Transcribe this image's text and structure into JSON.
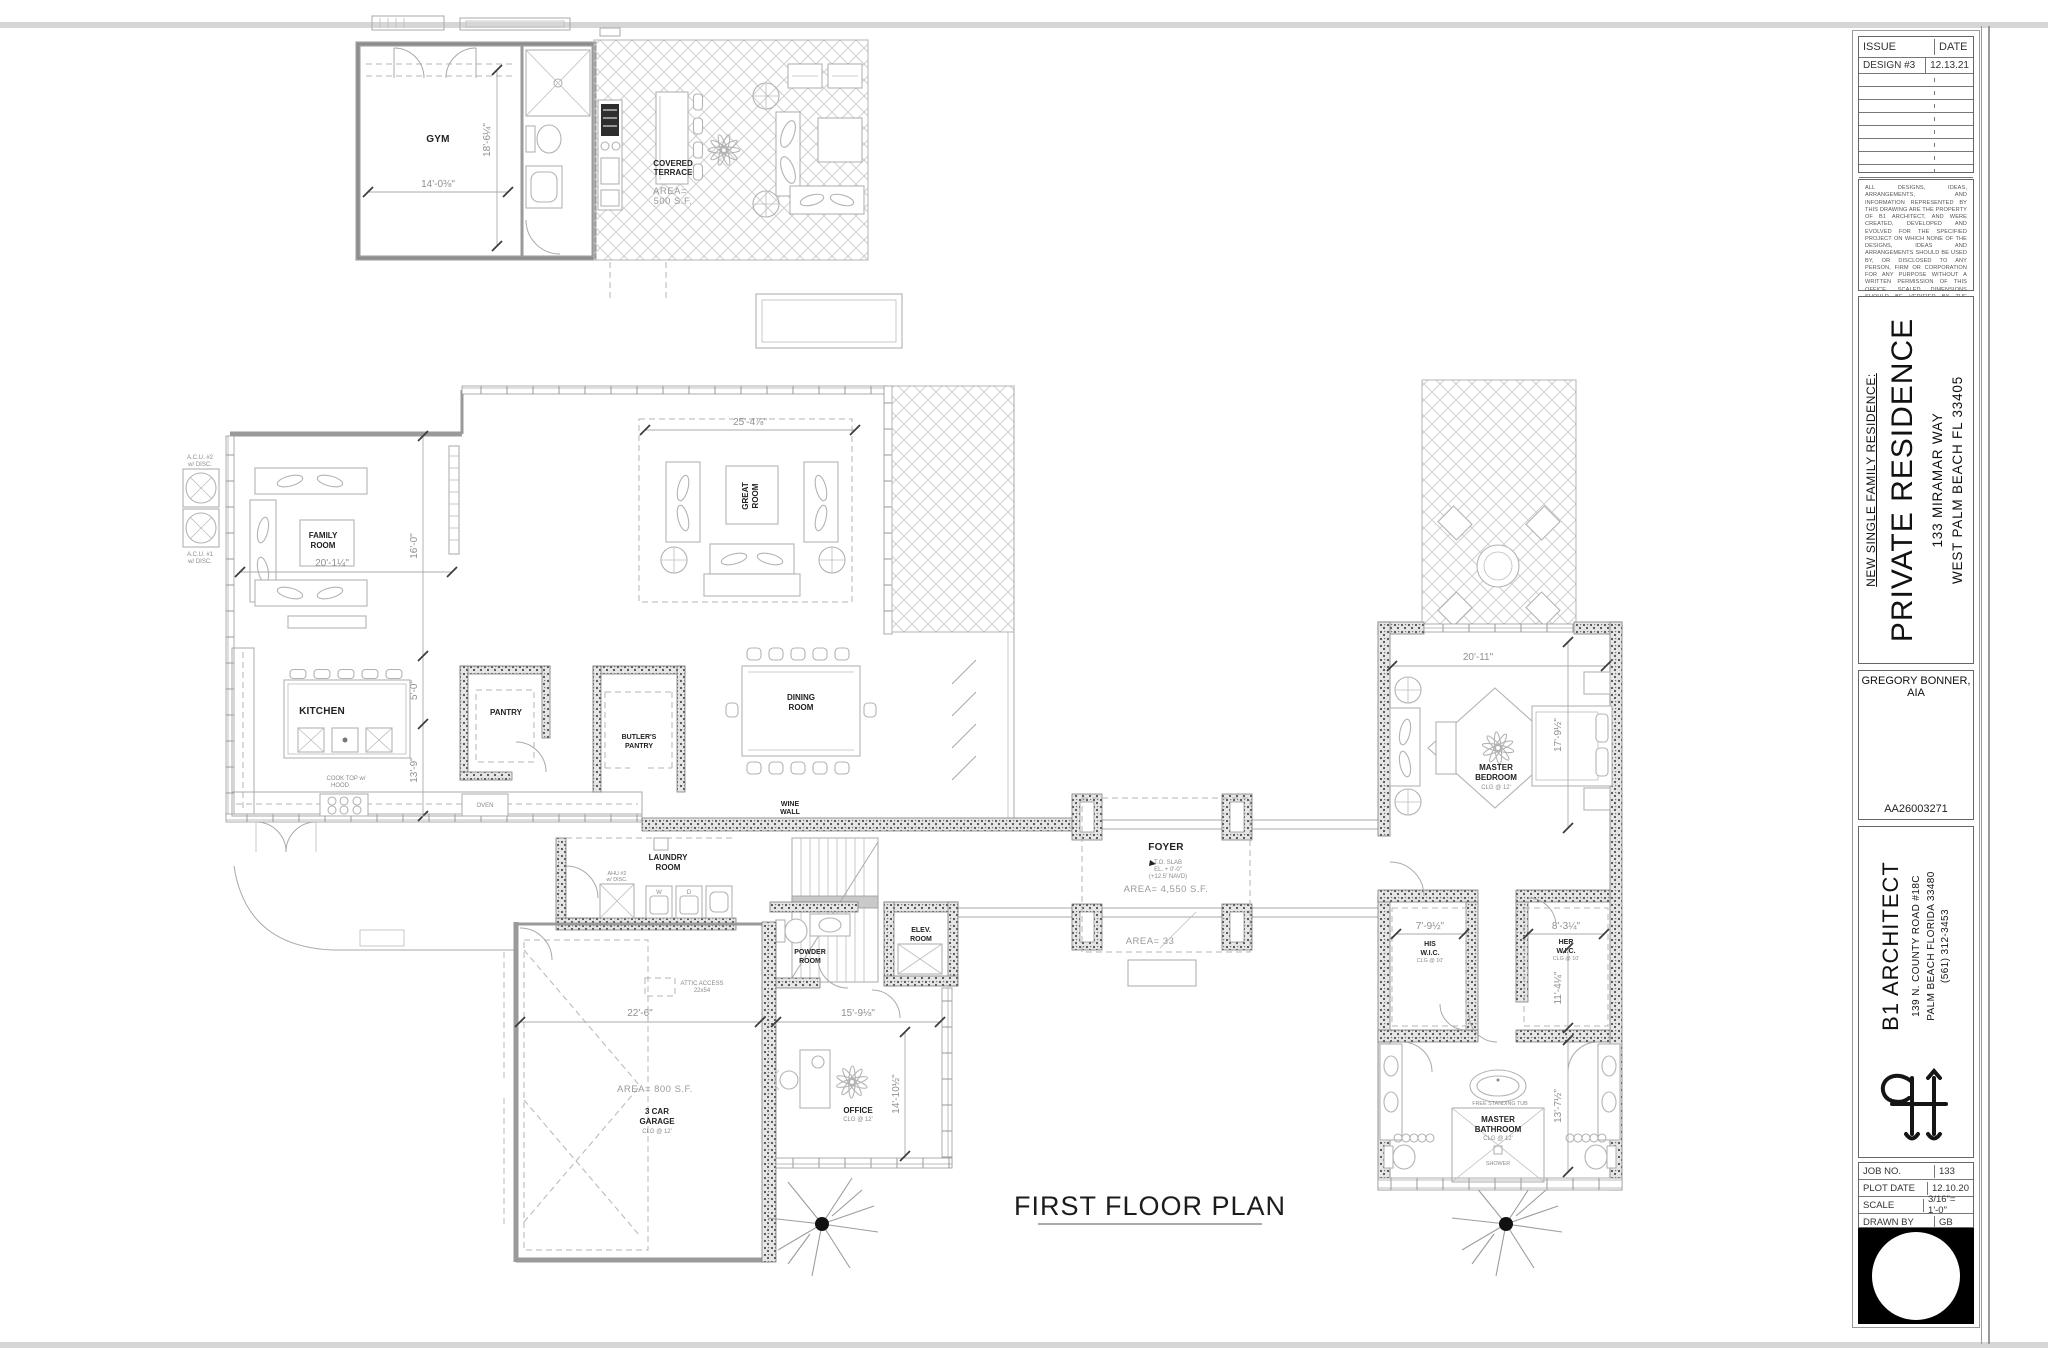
{
  "plan": {
    "title": "FIRST FLOOR PLAN",
    "rooms": {
      "gym": "GYM",
      "covered_terrace": [
        "COVERED",
        "TERRACE"
      ],
      "covered_terrace_area": [
        "AREA=",
        "500 S.F."
      ],
      "family_room": [
        "FAMILY",
        "ROOM"
      ],
      "great_room": [
        "GREAT",
        "ROOM"
      ],
      "kitchen": "KITCHEN",
      "pantry": "PANTRY",
      "butlers_pantry": [
        "BUTLER'S",
        "PANTRY"
      ],
      "dining_room": [
        "DINING",
        "ROOM"
      ],
      "wine_wall": [
        "WINE",
        "WALL"
      ],
      "laundry_room": [
        "LAUNDRY",
        "ROOM"
      ],
      "powder_room": [
        "POWDER",
        "ROOM"
      ],
      "elev_room": [
        "ELEV.",
        "ROOM"
      ],
      "foyer": "FOYER",
      "garage": [
        "3 CAR",
        "GARAGE"
      ],
      "office": "OFFICE",
      "master_bedroom": [
        "MASTER",
        "BEDROOM"
      ],
      "his_wic": [
        "HIS",
        "W.I.C."
      ],
      "her_wic": [
        "HER",
        "W.I.C."
      ],
      "master_bathroom": [
        "MASTER",
        "BATHROOM"
      ],
      "shower": "SHOWER",
      "tub": "FREE STANDING TUB"
    },
    "notes": {
      "slab": [
        "T.O. SLAB",
        "EL. + 0'-0\"",
        "(+12.5' NAVD)"
      ],
      "foyer_area": "AREA=  4,550 S.F.",
      "entry_area": "AREA= 33",
      "garage_area": "AREA=  800 S.F.",
      "clg12": "CLG @ 12'",
      "clg10": "CLG @ 10'",
      "attic1": "ATTIC ACCESS",
      "attic2": "22x54",
      "cooktop1": "COOK TOP  w/",
      "cooktop2": "HOOD",
      "oven": "OVEN",
      "washer": "W",
      "dryer": "D",
      "ahu": [
        "AHU #2",
        "w/ DISC."
      ],
      "acu1": [
        "A.C.U.  #1",
        "w/ DISC."
      ],
      "acu2": [
        "A.C.U.  #2",
        "w/ DISC."
      ]
    },
    "dims": {
      "gym_w": "14'-0⅜\"",
      "gym_h": "18'-6¼\"",
      "great_w": "25'-4⅞\"",
      "family_w": "20'-1¼\"",
      "left_a": "16'-0\"",
      "left_b": "5'-0\"",
      "left_c": "13'-9\"",
      "garage_w": "22'-6\"",
      "office_w": "15'-9⅛\"",
      "office_h": "14'-10½\"",
      "master_w": "20'-11\"",
      "master_h": "17'-9½\"",
      "his_w": "7'-9½\"",
      "her_w": "8'-3¼\"",
      "her_h": "11'-4¼\"",
      "bath_h": "13'-7½\""
    }
  },
  "titleblock": {
    "issue": {
      "col_issue": "ISSUE",
      "col_date": "DATE",
      "row1_issue": "DESIGN #3",
      "row1_date": "12.13.21"
    },
    "disclaimer": "ALL DESIGNS, IDEAS, ARRANGEMENTS, AND INFORMATION REPRESENTED BY THIS DRAWING ARE THE PROPERTY OF B1 ARCHITECT, AND WERE CREATED, DEVELOPED AND EVOLVED FOR THE SPECIFIED PROJECT ON WHICH NONE OF THE DESIGNS, IDEAS AND ARRANGEMENTS SHOULD BE USED BY, OR DISCLOSED TO ANY PERSON, FIRM OR CORPORATION FOR ANY PURPOSE WITHOUT A WRITTEN PERMISSION OF THIS OFFICE. SCALED DIMENSIONS SHOULD BE VERIFIED BY THE CONTRACTOR WHO SHALL BE RESPONSIBLE FOR ALL DIMENSIONS AND CONDITIONS OF THE JOB. WRITTEN DIMENSIONS SHALL TAKE PRECEDENCE OVER SCALED DIMENSIONS. CONTRACTOR SHALL NOTIFY THIS OFFICE OF ANY VARIATIONS IN DIMENSIONS AND CONDITIONS SHOWN ON THESE DRAWINGS. SHOP DETAILS WITH ADEQUATE DIMENSIONS AND SCALE MUST BE SUBMITTED TO THIS OFFICE FOR APPROVAL BEFORE PROCEEDING WITH FABRICATION OF THE ITEMS INDICATED.",
    "project": {
      "kicker": "NEW  SINGLE FAMILY RESIDENCE:",
      "name": "PRIVATE RESIDENCE",
      "address1": "133 MIRAMAR WAY",
      "address2": "WEST PALM BEACH  FL 33405"
    },
    "architect": {
      "name": "GREGORY BONNER, AIA",
      "license": "AA26003271"
    },
    "firm": {
      "name": "B1 ARCHITECT",
      "address1": "139 N. COUNTY ROAD #18C",
      "address2": "PALM BEACH FLORIDA 33480",
      "phone": "(561) 312-3453"
    },
    "info": {
      "r1l": "JOB NO.",
      "r1v": "133",
      "r2l": "PLOT DATE",
      "r2v": "12.10.20",
      "r3l": "SCALE",
      "r3v": "3/16\"= 1'-0\"",
      "r4l": "DRAWN BY",
      "r4v": "GB"
    }
  }
}
